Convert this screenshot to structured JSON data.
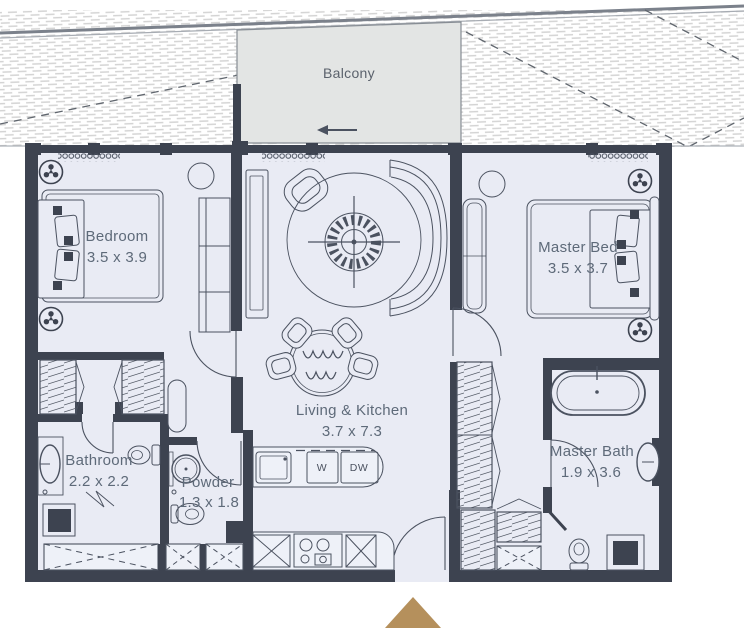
{
  "title": "Apartment floor plan",
  "palette": {
    "wall": "#3d4350",
    "floor": "#e9ebf4",
    "balcony_fill": "#e3e5e4",
    "furniture_line": "#4b5260",
    "label_text": "#5e6a79",
    "hatch": "#d4d4d4",
    "entrance_marker": "#b5905c"
  },
  "exterior": {
    "balcony_label": "Balcony"
  },
  "rooms": [
    {
      "id": "bedroom",
      "label": "Bedroom",
      "dims": "3.5 x 3.9"
    },
    {
      "id": "living-kitchen",
      "label": "Living & Kitchen",
      "dims": "3.7 x 7.3"
    },
    {
      "id": "master-bedroom",
      "label": "Master Bed",
      "dims": "3.5 x 3.7"
    },
    {
      "id": "bathroom",
      "label": "Bathroom",
      "dims": "2.2 x 2.2"
    },
    {
      "id": "powder-room",
      "label": "Powder",
      "dims": "1.3 x 1.8"
    },
    {
      "id": "master-bathroom",
      "label": "Master Bath",
      "dims": "1.9 x 3.6"
    }
  ],
  "appliances": {
    "washer": "W",
    "dishwasher": "DW"
  }
}
